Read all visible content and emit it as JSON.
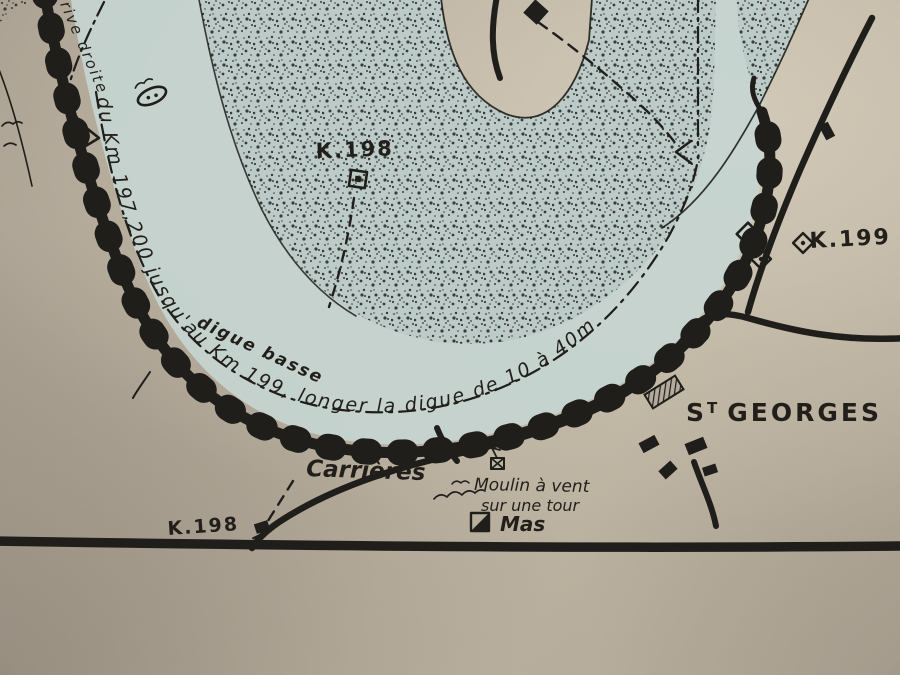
{
  "map": {
    "description": "hand-drawn-river-navigation-sketch",
    "labels": {
      "route_instruction": "du Km 197,200 jusqu'au Km 199, longer la digue de 10 à 40m",
      "rive_droite": "rive droite",
      "digue_basse": "digue basse",
      "km198_top": "K.198",
      "km199": "K.199",
      "km198_bottom": "K.198",
      "st_georges": {
        "s": "S",
        "t": "T",
        "rest": "GEORGES"
      },
      "carrieres": "Carrières",
      "moulin_line1": "Moulin à vent",
      "moulin_line2": "sur une tour",
      "mas": "Mas"
    },
    "colors": {
      "paper": "#b5ab9b",
      "water_wash": "#c6d5d1",
      "sandbank_wash": "#bccbc7",
      "ink": "#1f1e1b",
      "stipple": "#383c39"
    }
  }
}
